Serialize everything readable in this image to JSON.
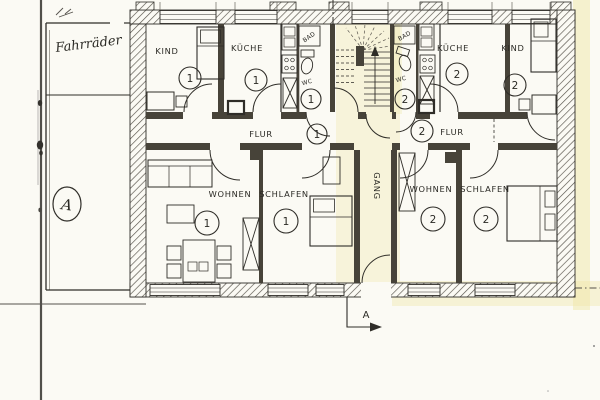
{
  "annex": {
    "label": "Fahrräder",
    "marker": "A"
  },
  "section_marker": {
    "label": "A"
  },
  "corridor": {
    "label": "GANG"
  },
  "apartments": [
    {
      "unit": "1",
      "rooms": {
        "kind": "KIND",
        "kueche": "KÜCHE",
        "bad": "BAD",
        "wc": "WC",
        "flur": "FLUR",
        "wohnen": "WOHNEN",
        "schlafen": "SCHLAFEN"
      }
    },
    {
      "unit": "2",
      "rooms": {
        "kind": "KIND",
        "kueche": "KÜCHE",
        "bad": "BAD",
        "wc": "WC",
        "flur": "FLUR",
        "wohnen": "WOHNEN",
        "schlafen": "SCHLAFEN"
      }
    }
  ],
  "colors": {
    "paper": "#fbfaf4",
    "ink": "#2f2d28",
    "wall_fill": "#474339",
    "highlight": "#efe7a8"
  }
}
